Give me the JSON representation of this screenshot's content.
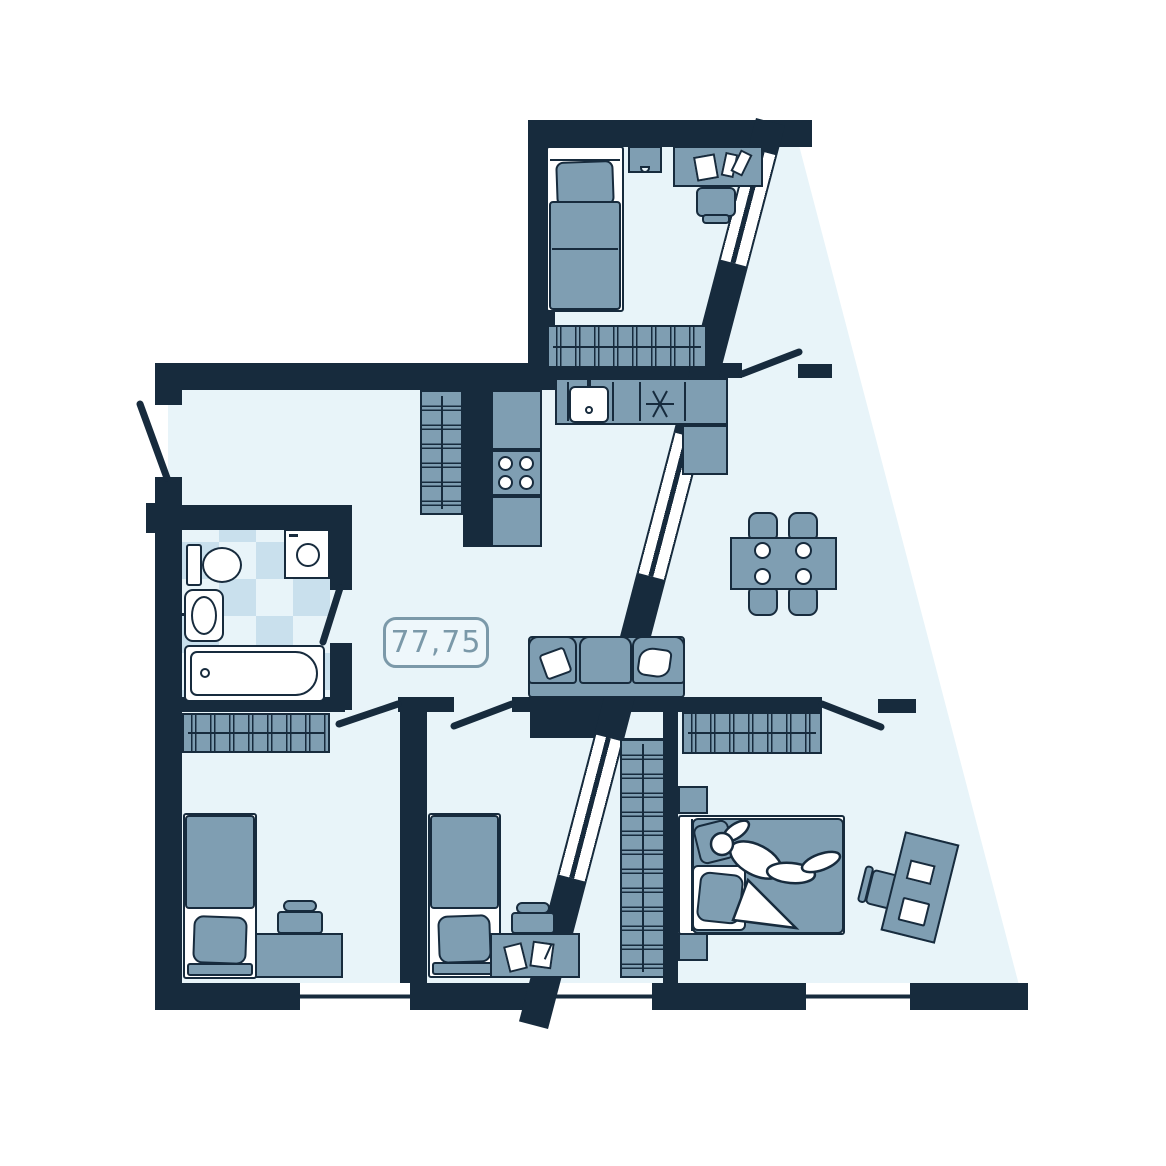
{
  "area_label": "77,75",
  "colors": {
    "wall": "#172b3d",
    "floor": "#e8f4f9",
    "furniture": "#7f9eb2",
    "tile": "#c9e0ed",
    "fixture": "#ffffff",
    "outside": "#ffffff",
    "label-text": "#7b99a9",
    "label-border": "#7b99a9",
    "label-bg": "#eef7fb"
  },
  "rooms": {
    "hallway": [
      "entrance-door",
      "wardrobe"
    ],
    "bathroom": [
      "tiled-floor",
      "toilet",
      "washing-machine",
      "washbasin",
      "bathtub",
      "door"
    ],
    "kitchen-living": [
      "l-shaped-counter",
      "kitchen-sink",
      "cooktop-4-burners",
      "vent-symbol",
      "dining-table",
      "four-plates",
      "four-chairs",
      "sofa",
      "two-pillows"
    ],
    "top-bedroom": [
      "single-bed",
      "nightstand",
      "desk",
      "books",
      "chair",
      "wardrobe",
      "door"
    ],
    "bedroom-1": [
      "wardrobe",
      "single-bed",
      "desk",
      "chair",
      "door"
    ],
    "bedroom-2": [
      "single-bed",
      "desk",
      "books",
      "chair",
      "wardrobe",
      "door"
    ],
    "master-bedroom": [
      "wardrobe",
      "double-bed",
      "person-lying",
      "nightstand",
      "nightstand",
      "desk",
      "books",
      "chair",
      "door"
    ]
  },
  "windows": {
    "bottom_wall": 3,
    "diagonal_wall": 3
  }
}
